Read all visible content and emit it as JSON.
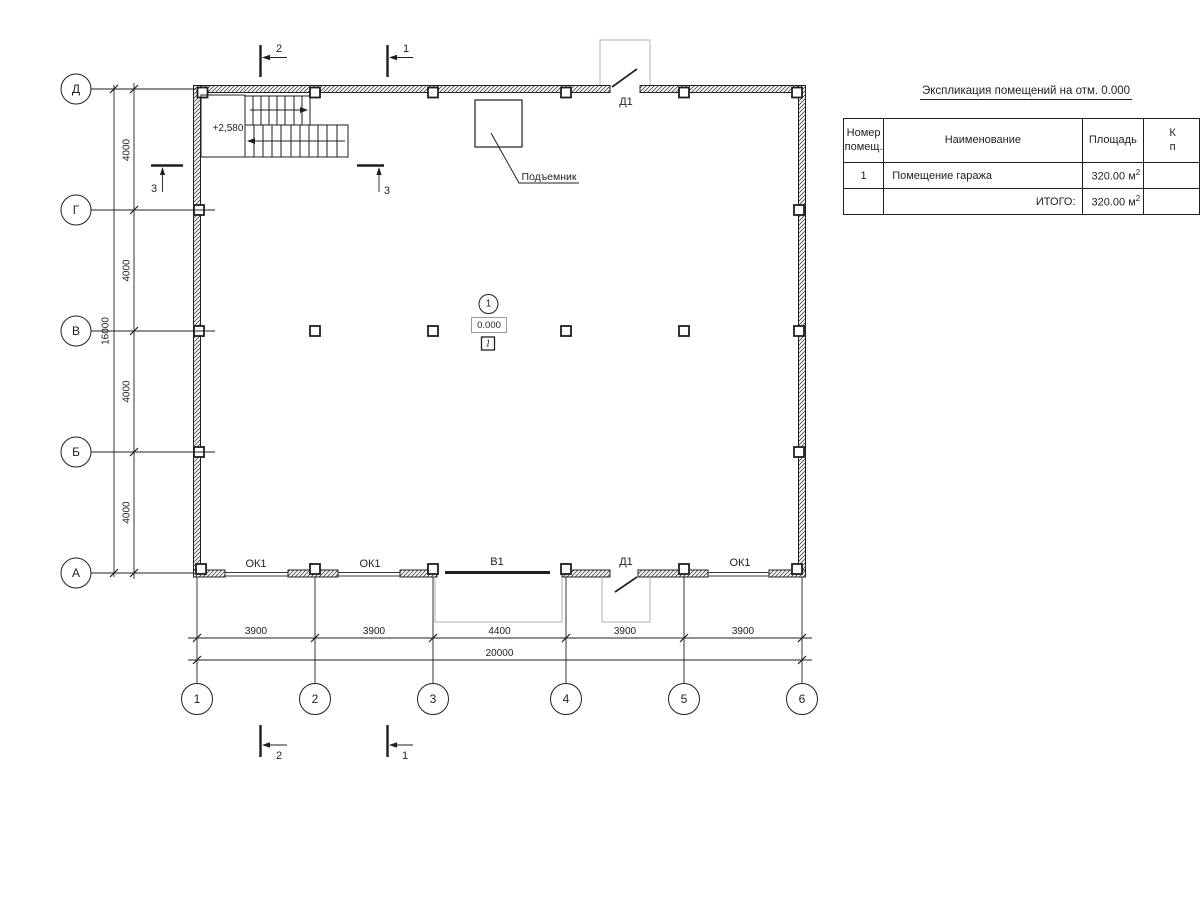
{
  "colors": {
    "line": "#1f1f1f",
    "muted": "#b0b0b0"
  },
  "plan": {
    "axes": {
      "rows": [
        "Д",
        "Г",
        "В",
        "Б",
        "А"
      ],
      "cols": [
        "1",
        "2",
        "3",
        "4",
        "5",
        "6"
      ]
    },
    "dims": {
      "left_bays": [
        "4000",
        "4000",
        "4000",
        "4000"
      ],
      "left_total": "16000",
      "bottom_bays": [
        "3900",
        "3900",
        "4400",
        "3900",
        "3900"
      ],
      "bottom_total": "20000"
    },
    "sections": {
      "cut1": "1",
      "cut2": "2",
      "cut3": "3"
    },
    "labels": {
      "stair_elevation": "+2,580",
      "lift": "Подъемник",
      "door_top": "Д1",
      "door_bottom": "Д1",
      "gate": "В1",
      "window_1": "ОК1",
      "window_2": "ОК1",
      "window_3": "ОК1",
      "axis_mark": "1",
      "elevation_mark": "0.000",
      "room_number": "1"
    }
  },
  "table": {
    "title": "Экспликация помещений на отм. 0.000",
    "headers": {
      "num_line1": "Номер",
      "num_line2": "помещ.",
      "name": "Наименование",
      "area": "Площадь",
      "cat_line1": "К",
      "cat_line2": "п"
    },
    "rows": [
      {
        "num": "1",
        "name": "Помещение гаража",
        "area": "320.00 м",
        "area_sup": "2"
      }
    ],
    "total": {
      "label": "ИТОГО:",
      "area": "320.00 м",
      "area_sup": "2"
    }
  }
}
